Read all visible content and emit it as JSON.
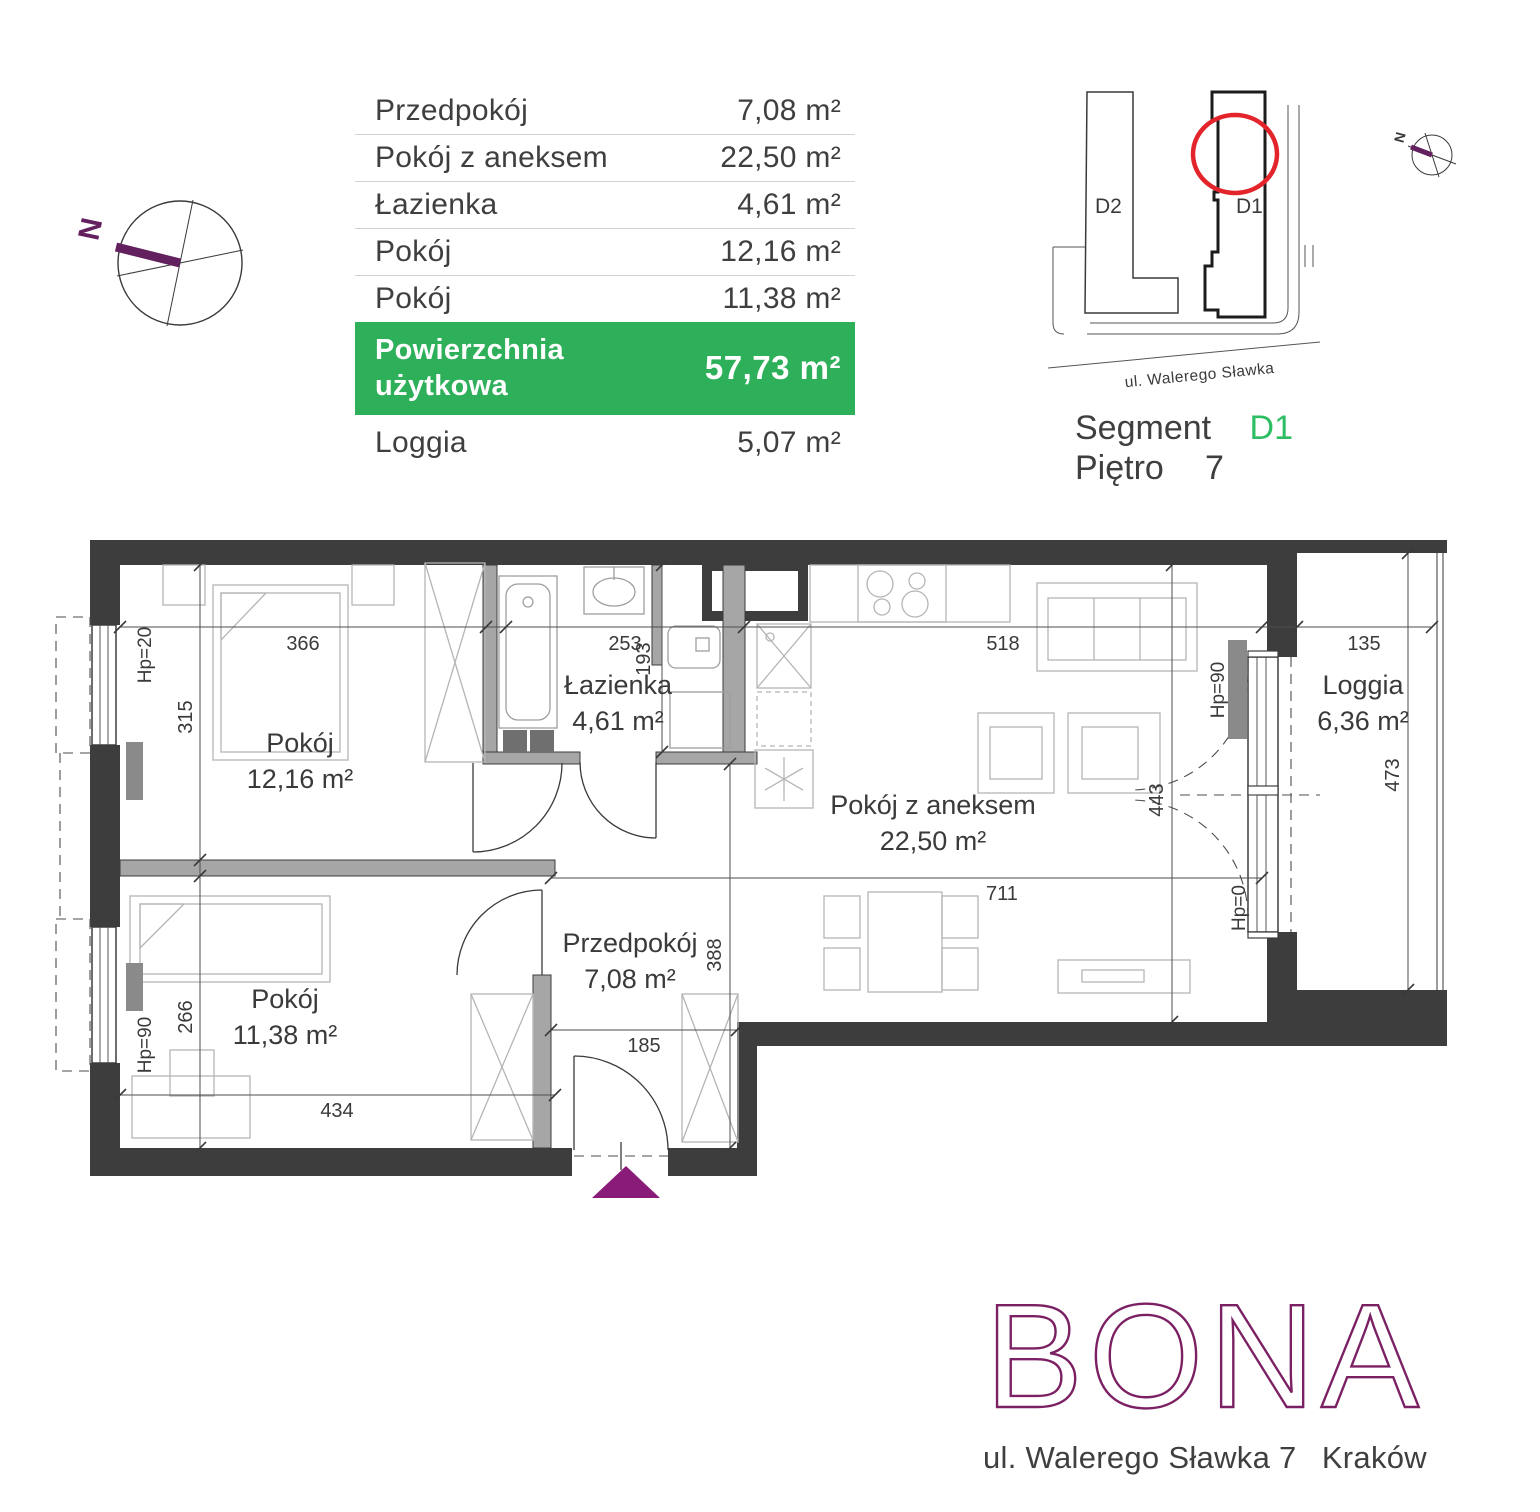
{
  "summary": {
    "rows": [
      {
        "label": "Przedpokój",
        "value": "7,08 m²"
      },
      {
        "label": "Pokój z aneksem",
        "value": "22,50 m²"
      },
      {
        "label": "Łazienka",
        "value": "4,61 m²"
      },
      {
        "label": "Pokój",
        "value": "12,16 m²"
      },
      {
        "label": "Pokój",
        "value": "11,38 m²"
      }
    ],
    "total_label": "Powierzchnia użytkowa",
    "total_value": "57,73 m²",
    "loggia_label": "Loggia",
    "loggia_value": "5,07 m²"
  },
  "locator": {
    "d2": "D2",
    "d1": "D1",
    "street": "ul. Walerego Sławka",
    "segment_label": "Segment",
    "segment_value": "D1",
    "floor_label": "Piętro",
    "floor_value": "7",
    "north": "N"
  },
  "compass": {
    "north": "N"
  },
  "plan": {
    "rooms": [
      {
        "name": "Pokój",
        "area": "12,16 m²"
      },
      {
        "name": "Pokój",
        "area": "11,38 m²"
      },
      {
        "name": "Łazienka",
        "area": "4,61 m²"
      },
      {
        "name": "Przedpokój",
        "area": "7,08 m²"
      },
      {
        "name": "Pokój z aneksem",
        "area": "22,50 m²"
      },
      {
        "name": "Loggia",
        "area": "6,36 m²"
      }
    ],
    "dims": {
      "w_bed1": "366",
      "w_bath": "253",
      "w_living": "518",
      "w_loggia": "135",
      "h_bed1": "315",
      "h_bed2": "266",
      "h_niche": "193",
      "h_hall": "388",
      "h_living": "443",
      "h_loggia": "473",
      "w_hall_living": "711",
      "w_entry": "185",
      "w_bed2": "434"
    },
    "hp": {
      "window_bed1": "Hp=20",
      "window_bed2": "Hp=90",
      "balcony_top": "Hp=90",
      "balcony_bottom": "Hp=0"
    }
  },
  "brand": {
    "logo": "BONA",
    "address": "ul. Walerego Sławka 7",
    "city": "Kraków"
  },
  "colors": {
    "accent_green": "#2eb05a",
    "segment_green": "#2dbd62",
    "logo_purple": "#7b2163",
    "marker_red": "#e3252b",
    "wall_dark": "#3d3d3d",
    "compass_purple": "#63205f",
    "entrance_purple": "#8a1c79"
  }
}
